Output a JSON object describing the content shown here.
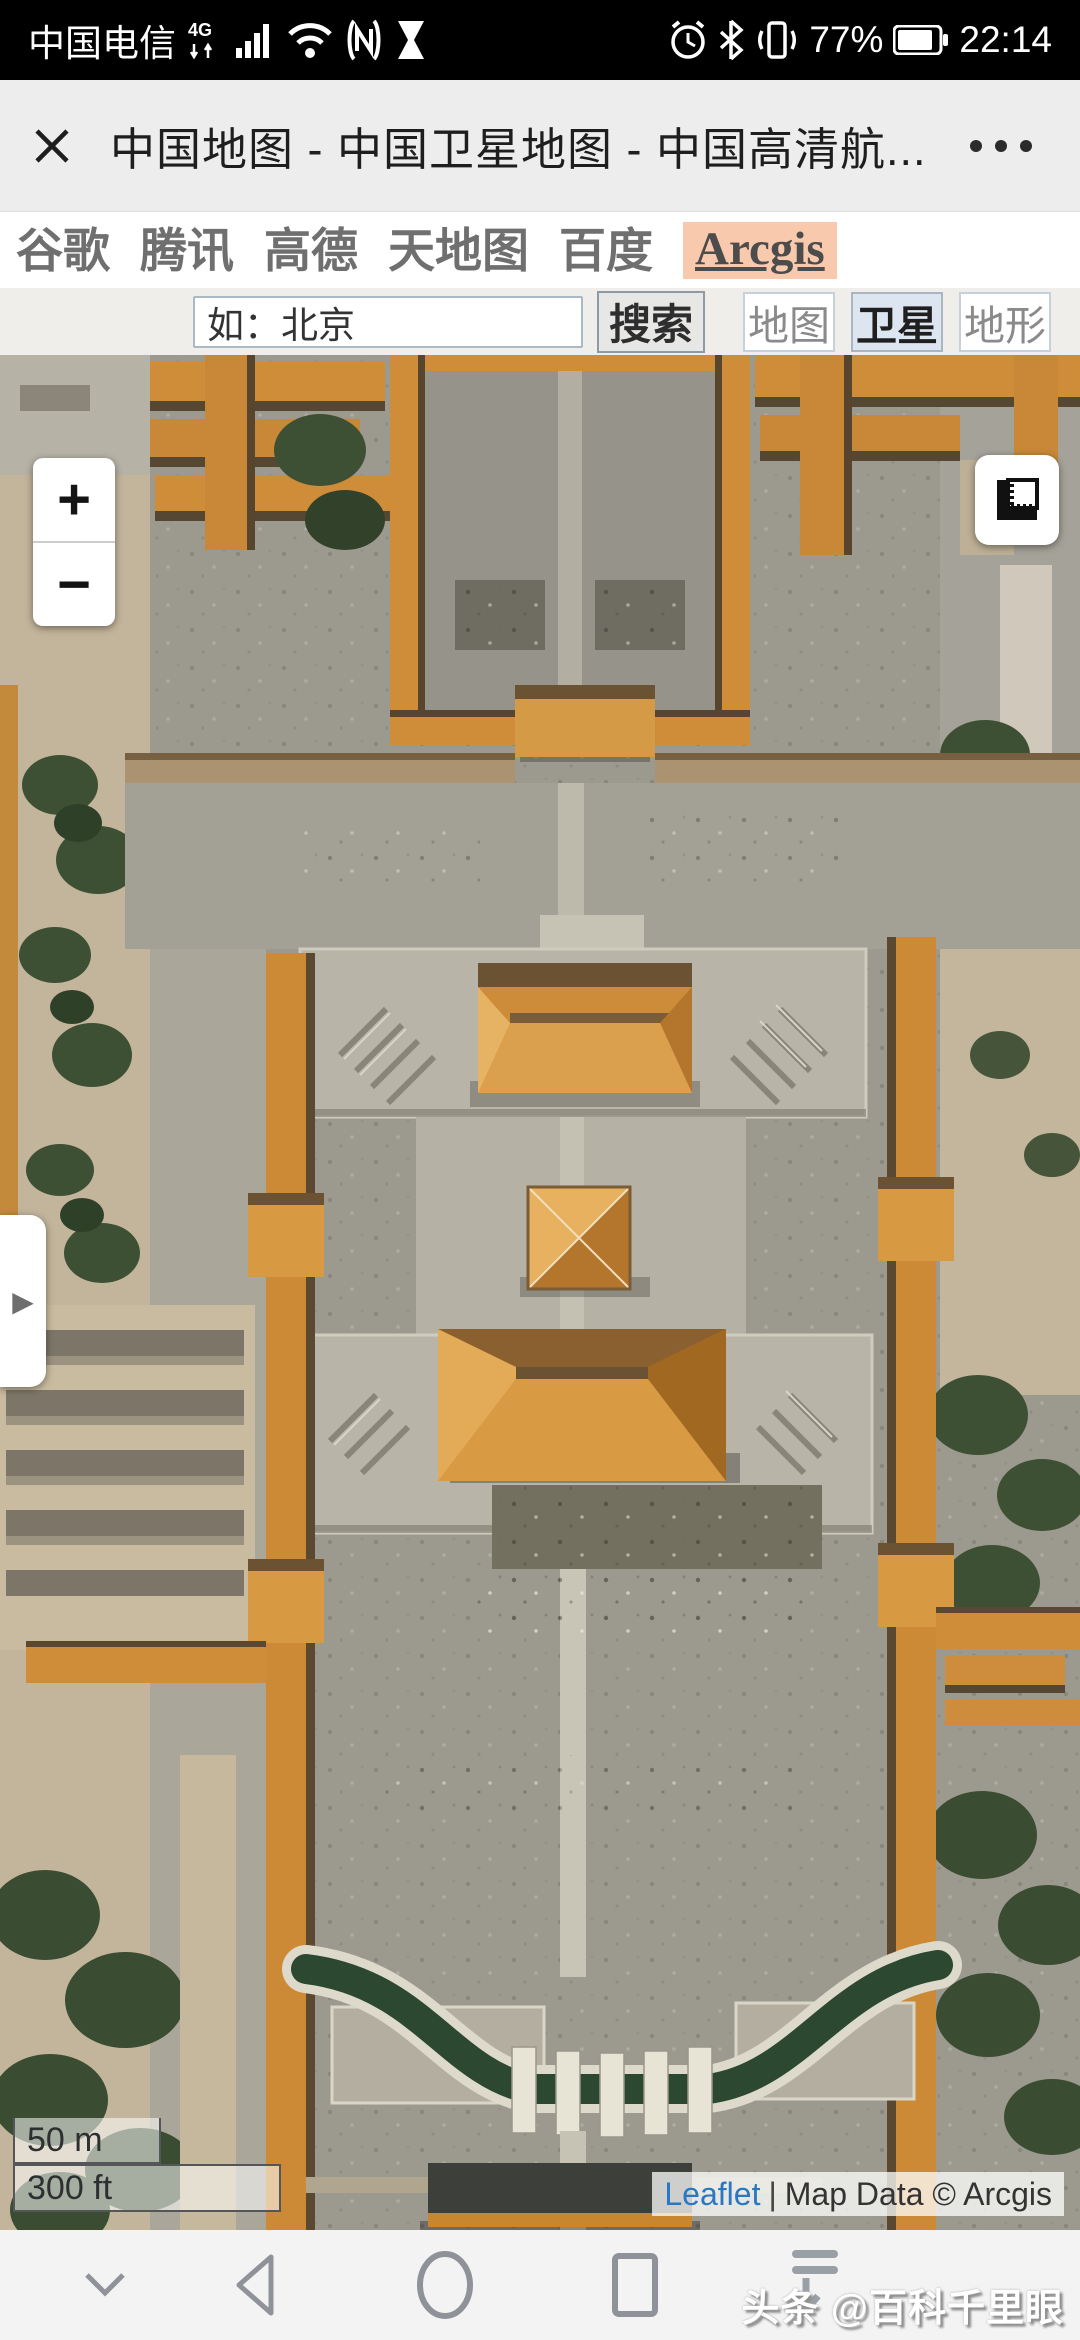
{
  "status_bar": {
    "carrier": "中国电信",
    "network_badge": "4G",
    "battery_percent": "77%",
    "time": "22:14",
    "icons": [
      "signal-bars",
      "wifi",
      "nfc",
      "hourglass",
      "alarm-clock",
      "bluetooth",
      "vibrate",
      "battery"
    ]
  },
  "title_bar": {
    "title": "中国地图 - 中国卫星地图 - 中国高清航..."
  },
  "provider_tabs": {
    "items": [
      {
        "label": "谷歌",
        "active": false
      },
      {
        "label": "腾讯",
        "active": false
      },
      {
        "label": "高德",
        "active": false
      },
      {
        "label": "天地图",
        "active": false
      },
      {
        "label": "百度",
        "active": false
      },
      {
        "label": "Arcgis",
        "active": true
      }
    ]
  },
  "search_bar": {
    "input_value": "如：北京",
    "search_button": "搜索",
    "layer_buttons": [
      {
        "label": "地图",
        "active": false
      },
      {
        "label": "卫星",
        "active": true
      },
      {
        "label": "地形",
        "active": false
      }
    ]
  },
  "map_controls": {
    "zoom_in": "+",
    "zoom_out": "−",
    "panel_toggle": "▶",
    "scale_metric": "50 m",
    "scale_imperial": "300 ft"
  },
  "attribution": {
    "leaflet_link": "Leaflet",
    "separator": "|",
    "credit": "Map Data © Arcgis"
  },
  "watermark": "头条 @百科千里眼",
  "map_description": "satellite imagery of the Forbidden City (Taihedian axis with Golden Water River), Beijing",
  "colors": {
    "status_bar_bg": "#000000",
    "tab_highlight": "#f9c9ae",
    "active_layer_bg": "#dde6f0",
    "leaflet_link": "#2a77c2",
    "roof_orange": "#cc8a37",
    "river_green": "#2d4830"
  }
}
